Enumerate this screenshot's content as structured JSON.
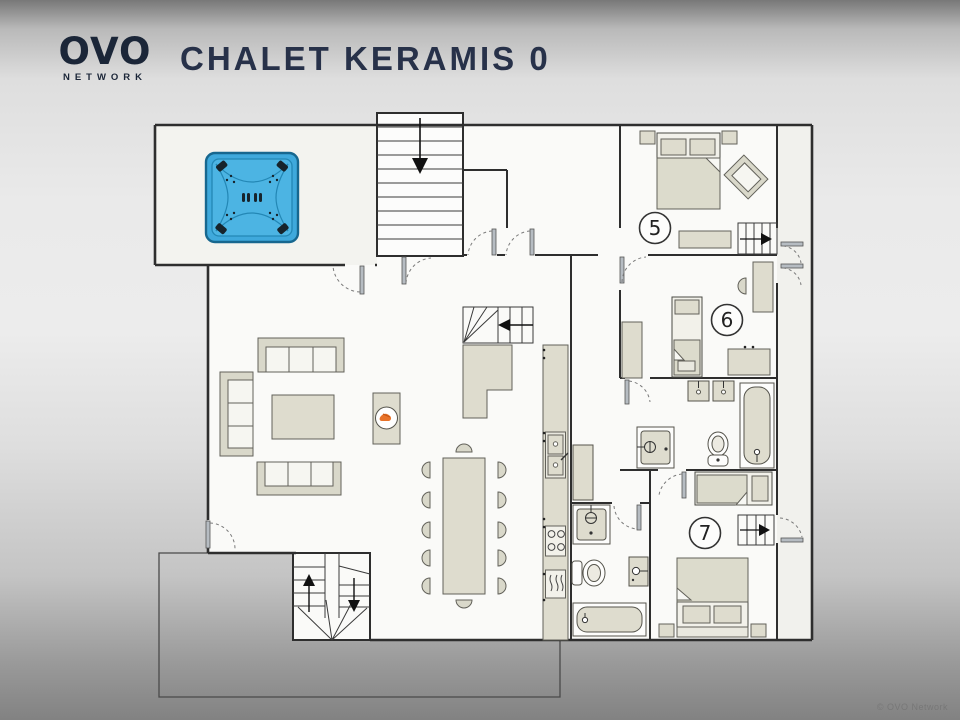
{
  "header": {
    "logo_text": "OVO",
    "logo_subtext": "NETWORK",
    "title": "CHALET KERAMIS 0"
  },
  "floorplan": {
    "rooms": [
      {
        "number": "5"
      },
      {
        "number": "6"
      },
      {
        "number": "7"
      }
    ]
  },
  "colors": {
    "wall": "#2e2e2e",
    "furniture_fill": "#dedcce",
    "hot_tub_blue": "#3fa9dc",
    "flame_orange": "#e8732a",
    "title_text": "#273149"
  },
  "footer": {
    "copyright": "© OVO Network"
  }
}
